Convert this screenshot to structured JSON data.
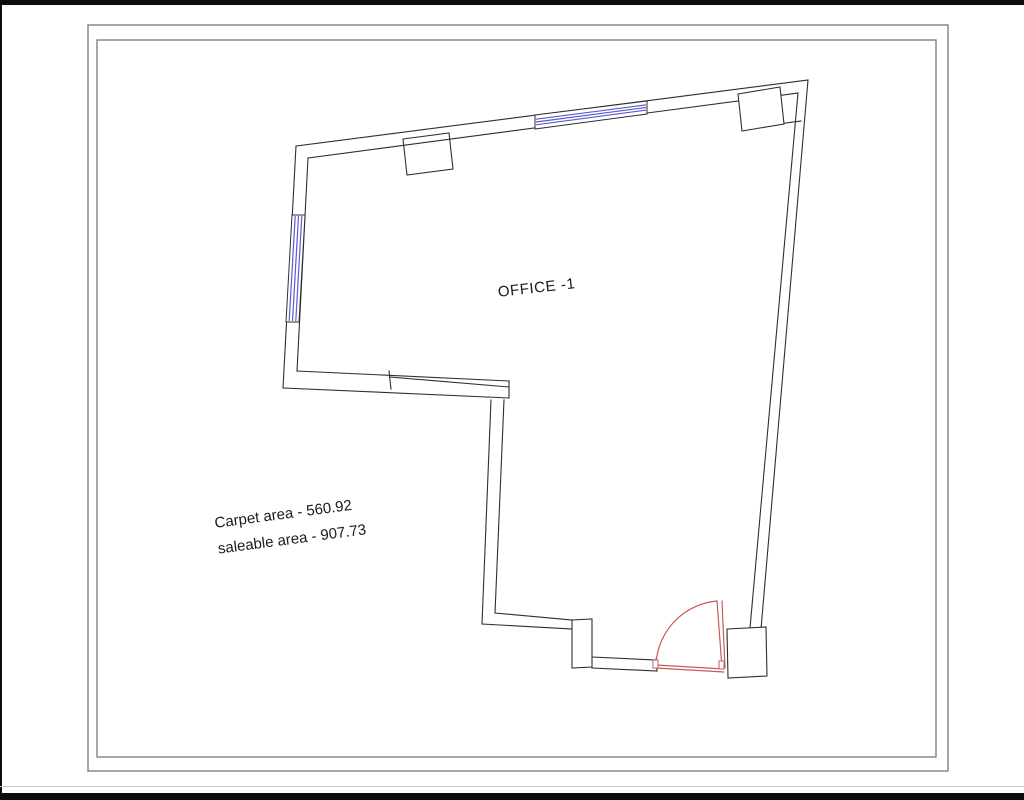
{
  "drawing": {
    "room_label": "OFFICE -1",
    "carpet_area_label": "Carpet area - 560.92",
    "saleable_area_label": "saleable area - 907.73",
    "carpet_area_value": "560.92",
    "saleable_area_value": "907.73"
  },
  "colors": {
    "background": "#ffffff",
    "letterbox": "#0d0d0d",
    "frame_line": "#808080",
    "wall_line": "#2e2e2e",
    "window_glass": "#5b5bd0",
    "door_swing": "#c75b5b"
  }
}
